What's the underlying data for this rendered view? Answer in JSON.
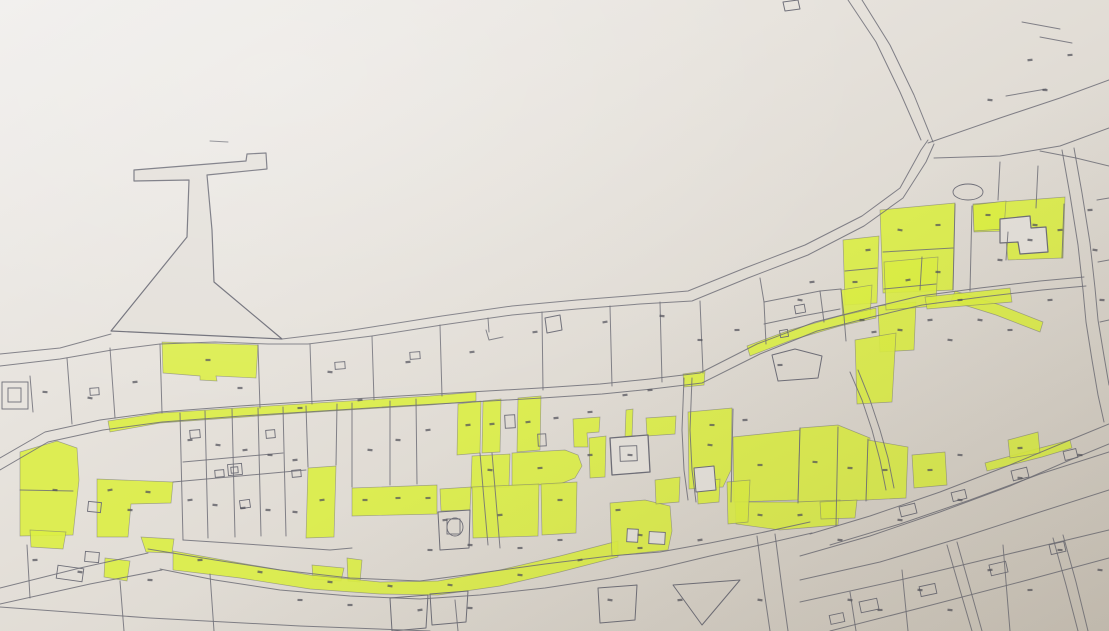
{
  "meta": {
    "description": "photograph of a paper cadastral parcel map with selected parcels highlighted in yellow-green marker; parcel numbers present but illegible",
    "legible_text": "none"
  },
  "colors": {
    "paper_light": "#f0eeec",
    "paper_mid1": "#e7e3dd",
    "paper_mid2": "#ddd8d0",
    "paper_dark": "#cfc8bd",
    "paper_shape": "#e4e0da",
    "line": "#6e6e78",
    "highlight": "#dcee44",
    "mark": "#50505a"
  },
  "map": {
    "width": 1109,
    "height": 631,
    "paper_shapes": [
      {
        "name": "pier",
        "pts": "134,170 246,161 247,154 266,153 267,169 207,175 212,230 214,282 282,339 111,331 187,237 189,180 134,181",
        "fill": "p",
        "w": 1.2
      },
      {
        "name": "church-block",
        "pts": "610,438 648,435 650,472 612,475",
        "fill": "p",
        "w": 1.3
      },
      {
        "name": "building-footprint",
        "pts": "1000,219 1030,216 1031,228 1046,227 1048,252 1020,254 1018,242 1000,243",
        "fill": "p",
        "w": 1.2
      },
      {
        "name": "building-footprint",
        "pts": "694,468 714,466 716,490 696,492",
        "fill": "p",
        "w": 1
      },
      {
        "name": "parcel",
        "pts": "772,355 795,349 822,356 818,378 778,381",
        "fill": "n",
        "w": 1
      },
      {
        "name": "shed-box",
        "pts": "783,2 798,0 800,9 785,11",
        "fill": "n",
        "w": 1
      },
      {
        "name": "parcel",
        "pts": "390,598 428,595 426,628 392,631",
        "fill": "n",
        "w": 1
      },
      {
        "name": "parcel",
        "pts": "430,594 468,591 466,622 432,625",
        "fill": "n",
        "w": 1
      },
      {
        "name": "parcel",
        "pts": "598,588 637,585 635,620 600,623",
        "fill": "n",
        "w": 1
      },
      {
        "name": "parcel-triangle",
        "pts": "673,585 740,580 702,625",
        "fill": "n",
        "w": 1
      },
      {
        "name": "parcel",
        "pts": "438,512 470,510 469,548 440,550",
        "fill": "n",
        "w": 1
      },
      {
        "name": "parcel",
        "pts": "545,318 560,315 562,330 547,333",
        "fill": "n",
        "w": 1
      }
    ],
    "highlighted_parcels": [
      "162,342 258,345 256,378 216,376 217,381 200,380 200,376 163,373",
      "108,421 160,413 300,404 430,396 476,392 476,401 430,405 300,413 160,423 110,432",
      "20,452 57,441 77,448 79,480 73,535 20,536",
      "97,479 173,482 171,503 131,504 128,537 97,537",
      "30,530 66,532 63,549 31,547",
      "141,537 174,539 172,553 146,552",
      "105,558 130,561 127,581 104,577",
      "308,468 336,466 334,537 306,538",
      "352,488 437,485 437,514 352,516",
      "312,565 344,568 341,581 313,579",
      "347,558 362,560 360,582 348,581",
      "173,551 240,563 310,575 380,582 438,581 500,570 560,556 618,541 618,557 560,572 500,586 438,595 380,594 310,589 240,578 173,570",
      "458,404 481,401 480,453 457,455",
      "483,401 501,399 500,452 482,453",
      "518,398 541,396 540,450 517,452",
      "573,419 600,417 599,432 587,433 588,447 574,447",
      "472,456 510,454 509,487 471,488",
      "512,453 565,450 578,455 582,466 575,478 560,484 512,486",
      "589,438 606,436 605,477 590,478",
      "626,410 633,409 632,437 625,438",
      "646,418 676,416 675,434 647,436",
      "440,489 471,487 470,510 441,511",
      "472,487 539,484 538,536 473,538",
      "541,484 577,482 576,533 542,535",
      "610,503 645,500 670,506 672,531 668,550 612,556",
      "655,480 680,477 679,502 656,504",
      "688,412 732,408 731,470 723,487 689,489",
      "733,437 800,430 798,500 734,502",
      "800,428 838,425 870,438 868,500 798,502",
      "735,502 798,502 840,500 838,525 780,530 736,524",
      "868,440 908,447 906,498 866,500",
      "820,502 857,500 855,518 821,519",
      "912,455 945,452 947,485 914,488",
      "697,482 720,479 719,502 698,504",
      "727,482 750,480 748,522 728,524",
      "880,210 955,203 953,290 883,293",
      "973,204 1065,197 1063,258 1008,260 1005,231 974,232",
      "843,240 879,236 877,303 845,305",
      "878,306 916,302 914,350 880,352",
      "855,340 896,333 892,402 857,404",
      "841,290 872,285 870,318 843,321",
      "884,262 938,257 936,306 886,310",
      "973,205 1006,201 1004,229 974,231",
      "747,346 790,330 840,316 876,308 876,318 840,326 792,340 750,356",
      "683,374 705,371 704,385 684,387",
      "955,291 1000,305 1043,322 1040,332 996,315 951,301",
      "985,463 1040,448 1070,440 1072,448 1042,457 987,471",
      "1008,440 1038,432 1040,453 1010,458",
      "925,297 1010,288 1012,302 927,309"
    ],
    "boundary_lines": [
      "0,354 60,348 111,334",
      "282,339 340,332 372,327 442,316 512,306 577,300 640,295 688,291 745,268 805,245 862,216 900,188 921,150 928,140",
      "0,366 60,359 112,350 160,344 215,342 268,344 308,344 372,336 442,325 512,315 577,309 640,304 692,301 748,278 808,255 864,226 903,198 926,162 934,144",
      "848,0 876,42 900,92 921,140",
      "862,0 890,45 914,95 933,142",
      "928,143 1000,118 1060,98 1109,80",
      "934,158 1000,156 1060,146 1109,128",
      "1040,151 1076,158 1109,166",
      "1062,150 1070,195 1078,245 1083,290 1086,322 1092,360 1098,395 1104,422",
      "1074,148 1082,193 1090,243 1095,288 1098,320 1104,356 1109,385",
      "0,458 45,432 100,420 160,412 240,406 320,401 400,396 470,392 540,388 600,384 650,379 700,373 757,344 815,322 870,308 920,296 980,288 1040,281 1084,277",
      "0,470 48,442 103,430 162,422 242,416 322,411 402,406 472,402 542,398 602,394 652,389 702,383 760,354 817,331 872,317 922,305 982,297 1042,290 1086,286",
      "810,534 870,516 940,492 1010,465 1070,440 1109,424",
      "800,556 870,536 940,512 1010,486 1070,460 1109,444",
      "800,580 880,562 960,538 1040,512 1109,490",
      "830,545 900,524 970,500 1040,474 1109,452",
      "148,549 215,560 280,570 350,578 420,581 480,573 545,564 610,556 660,552 710,543 760,533 810,522",
      "160,569 215,580 280,590 350,596 420,599 480,595 545,588 610,578 660,568 710,556 760,545 812,533",
      "148,553 80,568 0,588",
      "162,570 90,584 0,604",
      "0,607 150,618 300,626 430,631",
      "757,536 764,590 770,631",
      "775,534 782,588 788,631",
      "947,545 960,590 972,631",
      "957,542 970,588 982,631",
      "1053,538 1066,585 1078,631",
      "1063,535 1076,582 1088,631",
      "850,372 862,400 872,430 880,460 886,490",
      "858,370 870,400 880,430 888,458 894,488",
      "480,453 484,500 488,545",
      "492,453 496,500 500,548",
      "684,378 682,430 684,470 688,500",
      "692,378 690,430 692,470 696,502",
      "30,376 33,412",
      "67,358 72,424",
      "110,348 115,418",
      "160,344 162,413",
      "258,345 260,408",
      "310,344 312,404",
      "372,336 374,400",
      "440,325 442,396",
      "542,312 543,390",
      "610,306 612,386",
      "660,302 662,382",
      "486,330 489,340 503,337",
      "488,318 489,332",
      "700,301 703,373",
      "760,278 764,302 766,344",
      "764,302 820,291 841,289",
      "764,324 802,316 840,309",
      "820,291 824,322",
      "841,289 844,316 846,341",
      "180,413 183,540",
      "205,411 208,538",
      "232,409 235,537",
      "258,408 261,536",
      "283,407 286,536",
      "306,406 308,467",
      "337,404 336,465",
      "352,403 352,487",
      "390,401 390,485",
      "416,399 417,484",
      "173,482 240,476 306,470",
      "183,462 283,453",
      "20,490 73,491",
      "183,540 260,545 330,550 352,548",
      "733,409 731,502",
      "800,428 798,503",
      "838,427 836,526",
      "868,439 866,501",
      "955,204 953,290",
      "972,206 970,291",
      "883,252 953,248",
      "922,257 920,290",
      "1008,232 1006,260",
      "1064,204 1062,258",
      "845,271 877,268",
      "884,289 936,284",
      "1000,162 998,200",
      "1038,166 1036,208",
      "1097,200 1109,198",
      "1098,262 1109,260",
      "1100,322 1109,320",
      "1022,22 1060,29",
      "1040,37 1072,43",
      "1006,96 1046,89",
      "210,141 228,142",
      "800,602 900,580 1000,556 1109,530",
      "830,631 920,608 1020,582 1109,558",
      "850,592 856,631",
      "902,570 908,631",
      "1003,545 1010,631",
      "27,545 30,598",
      "120,581 124,631",
      "210,574 214,631",
      "455,600 458,631"
    ],
    "buildings": [
      [
        2,
        382,
        26,
        27,
        0,
        0
      ],
      [
        8,
        388,
        13,
        14,
        0,
        0
      ],
      [
        190,
        430,
        10,
        8,
        -5,
        0
      ],
      [
        215,
        470,
        9,
        7,
        -5,
        0
      ],
      [
        240,
        500,
        10,
        8,
        -8,
        0
      ],
      [
        266,
        430,
        9,
        8,
        -5,
        0
      ],
      [
        292,
        470,
        9,
        7,
        -5,
        0
      ],
      [
        228,
        464,
        14,
        11,
        -5,
        0
      ],
      [
        231,
        467,
        7,
        6,
        -5,
        0
      ],
      [
        88,
        502,
        13,
        10,
        6,
        0
      ],
      [
        90,
        388,
        9,
        7,
        -4,
        0
      ],
      [
        335,
        362,
        10,
        7,
        -4,
        0
      ],
      [
        410,
        352,
        10,
        7,
        -4,
        0
      ],
      [
        505,
        415,
        10,
        13,
        -3,
        0
      ],
      [
        538,
        434,
        8,
        12,
        -3,
        0
      ],
      [
        620,
        446,
        17,
        15,
        -2,
        0
      ],
      [
        795,
        305,
        10,
        8,
        -10,
        0
      ],
      [
        780,
        330,
        8,
        7,
        -10,
        0
      ],
      [
        57,
        567,
        26,
        13,
        8,
        0
      ],
      [
        85,
        552,
        14,
        10,
        5,
        0
      ],
      [
        860,
        600,
        18,
        11,
        -12,
        0
      ],
      [
        920,
        585,
        16,
        10,
        -12,
        0
      ],
      [
        990,
        563,
        17,
        11,
        -13,
        0
      ],
      [
        1050,
        543,
        15,
        10,
        -13,
        0
      ],
      [
        830,
        614,
        14,
        9,
        -12,
        0
      ],
      [
        900,
        505,
        16,
        10,
        -14,
        0
      ],
      [
        952,
        491,
        14,
        9,
        -14,
        0
      ],
      [
        1012,
        469,
        16,
        10,
        -14,
        0
      ],
      [
        1064,
        450,
        13,
        9,
        -14,
        0
      ],
      [
        627,
        529,
        11,
        13,
        3,
        1
      ],
      [
        649,
        532,
        16,
        12,
        3,
        1
      ],
      [
        447,
        519,
        13,
        15,
        0,
        0
      ]
    ],
    "ellipses": [
      [
        968,
        192,
        15,
        8
      ],
      [
        455,
        527,
        8,
        9
      ]
    ],
    "number_marks": [
      [
        45,
        392
      ],
      [
        90,
        398
      ],
      [
        135,
        382
      ],
      [
        208,
        360
      ],
      [
        240,
        388
      ],
      [
        330,
        372
      ],
      [
        408,
        362
      ],
      [
        472,
        352
      ],
      [
        535,
        332
      ],
      [
        605,
        322
      ],
      [
        662,
        316
      ],
      [
        700,
        340
      ],
      [
        737,
        330
      ],
      [
        800,
        300
      ],
      [
        812,
        282
      ],
      [
        780,
        365
      ],
      [
        300,
        408
      ],
      [
        360,
        400
      ],
      [
        855,
        282
      ],
      [
        868,
        250
      ],
      [
        900,
        230
      ],
      [
        938,
        225
      ],
      [
        938,
        272
      ],
      [
        988,
        215
      ],
      [
        1035,
        225
      ],
      [
        908,
        280
      ],
      [
        862,
        320
      ],
      [
        874,
        332
      ],
      [
        900,
        330
      ],
      [
        930,
        320
      ],
      [
        960,
        300
      ],
      [
        1000,
        260
      ],
      [
        1030,
        240
      ],
      [
        1060,
        230
      ],
      [
        1090,
        210
      ],
      [
        1095,
        250
      ],
      [
        1102,
        300
      ],
      [
        1050,
        300
      ],
      [
        980,
        320
      ],
      [
        950,
        340
      ],
      [
        1010,
        330
      ],
      [
        190,
        440
      ],
      [
        218,
        445
      ],
      [
        245,
        450
      ],
      [
        270,
        455
      ],
      [
        295,
        460
      ],
      [
        322,
        500
      ],
      [
        370,
        450
      ],
      [
        398,
        440
      ],
      [
        428,
        430
      ],
      [
        190,
        500
      ],
      [
        215,
        505
      ],
      [
        243,
        508
      ],
      [
        268,
        510
      ],
      [
        295,
        512
      ],
      [
        365,
        500
      ],
      [
        398,
        498
      ],
      [
        428,
        498
      ],
      [
        55,
        490
      ],
      [
        130,
        510
      ],
      [
        110,
        490
      ],
      [
        148,
        492
      ],
      [
        468,
        425
      ],
      [
        492,
        424
      ],
      [
        528,
        422
      ],
      [
        556,
        418
      ],
      [
        590,
        412
      ],
      [
        625,
        395
      ],
      [
        650,
        390
      ],
      [
        490,
        470
      ],
      [
        540,
        468
      ],
      [
        560,
        500
      ],
      [
        500,
        515
      ],
      [
        445,
        520
      ],
      [
        590,
        455
      ],
      [
        630,
        455
      ],
      [
        618,
        510
      ],
      [
        640,
        535
      ],
      [
        520,
        548
      ],
      [
        560,
        540
      ],
      [
        470,
        545
      ],
      [
        430,
        550
      ],
      [
        710,
        445
      ],
      [
        760,
        465
      ],
      [
        815,
        462
      ],
      [
        850,
        468
      ],
      [
        885,
        470
      ],
      [
        760,
        515
      ],
      [
        800,
        515
      ],
      [
        712,
        425
      ],
      [
        745,
        420
      ],
      [
        930,
        470
      ],
      [
        960,
        455
      ],
      [
        1020,
        448
      ],
      [
        200,
        560
      ],
      [
        260,
        572
      ],
      [
        330,
        582
      ],
      [
        390,
        586
      ],
      [
        450,
        585
      ],
      [
        520,
        575
      ],
      [
        580,
        560
      ],
      [
        640,
        548
      ],
      [
        700,
        540
      ],
      [
        610,
        600
      ],
      [
        680,
        600
      ],
      [
        760,
        600
      ],
      [
        850,
        600
      ],
      [
        920,
        590
      ],
      [
        990,
        570
      ],
      [
        1060,
        550
      ],
      [
        900,
        520
      ],
      [
        960,
        500
      ],
      [
        1020,
        478
      ],
      [
        1080,
        455
      ],
      [
        840,
        540
      ],
      [
        880,
        610
      ],
      [
        950,
        610
      ],
      [
        1030,
        590
      ],
      [
        1100,
        570
      ],
      [
        420,
        610
      ],
      [
        470,
        608
      ],
      [
        350,
        605
      ],
      [
        300,
        600
      ],
      [
        150,
        580
      ],
      [
        80,
        572
      ],
      [
        35,
        560
      ],
      [
        1030,
        60
      ],
      [
        1070,
        55
      ],
      [
        990,
        100
      ],
      [
        1045,
        90
      ]
    ]
  }
}
